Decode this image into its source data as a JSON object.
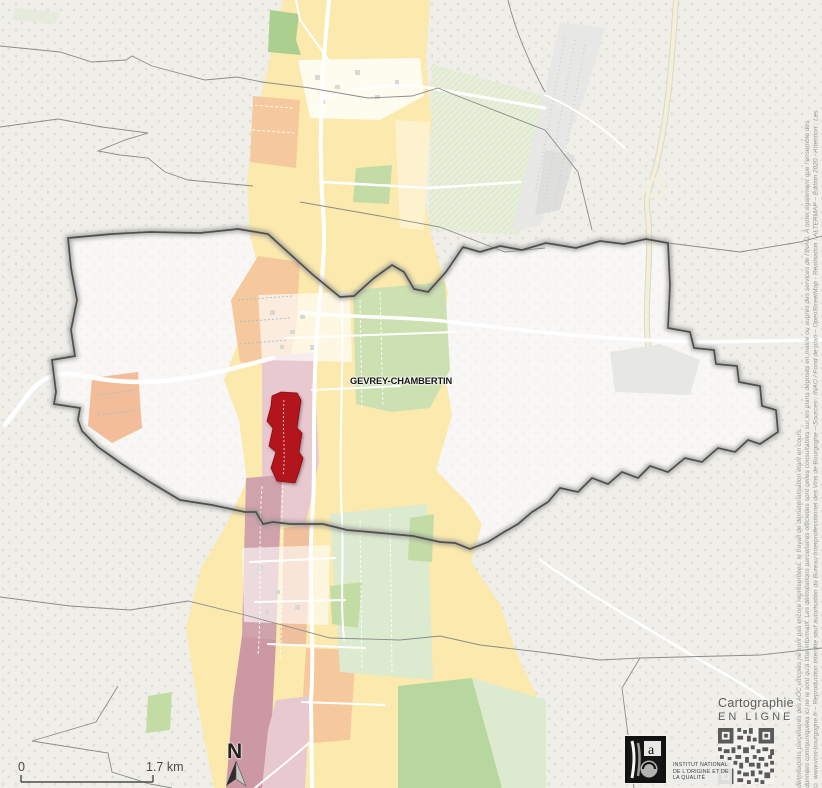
{
  "map": {
    "commune_label": "GEVREY-CHAMBERTIN",
    "scale_bar": {
      "start_label": "0",
      "end_label": "1.7 km"
    },
    "north_arrow_label": "N"
  },
  "branding": {
    "cartographie_title": "Cartographie",
    "cartographie_subtitle": "EN LIGNE",
    "inao_lines": [
      "INSTITUT NATIONAL",
      "DE L'ORIGINE ET DE",
      "LA QUALITÉ"
    ]
  },
  "copyright_lines": [
    "© www.vins-bourgogne.fr – Reproduction interdite sauf autorisation du Bureau Interprofessionnel des Vins de Bourgogne – Sources : INAO / Fond de plan – OpenStreetMap - Réalisation : ALTERMAP – Édition 2020 - Attention : Les",
    "données communiquées ici ne le sont qu'à titre informatif. Les délimitations parcellaires officielles sont celles consultables sur les plans déposés en mairie ou auprès des services de l'INAO. À noter également que l'ensemble des",
    "délimitations parcellaires des AOC viticoles ne sont pas encore représentées, le travail de dématérialisation étant en cours."
  ],
  "colors": {
    "grand_cru_red": "#b2121f",
    "village_yellow": "#fbe9ad",
    "premier_cru_orange": "#f5c99d",
    "pink": "#e8c9cf",
    "mauve": "#d0a2ac",
    "green_light": "#dcead0",
    "green_medium": "#c3dca6",
    "background_gray": "#efeee9",
    "boundary_gray": "#4f4f4d"
  }
}
